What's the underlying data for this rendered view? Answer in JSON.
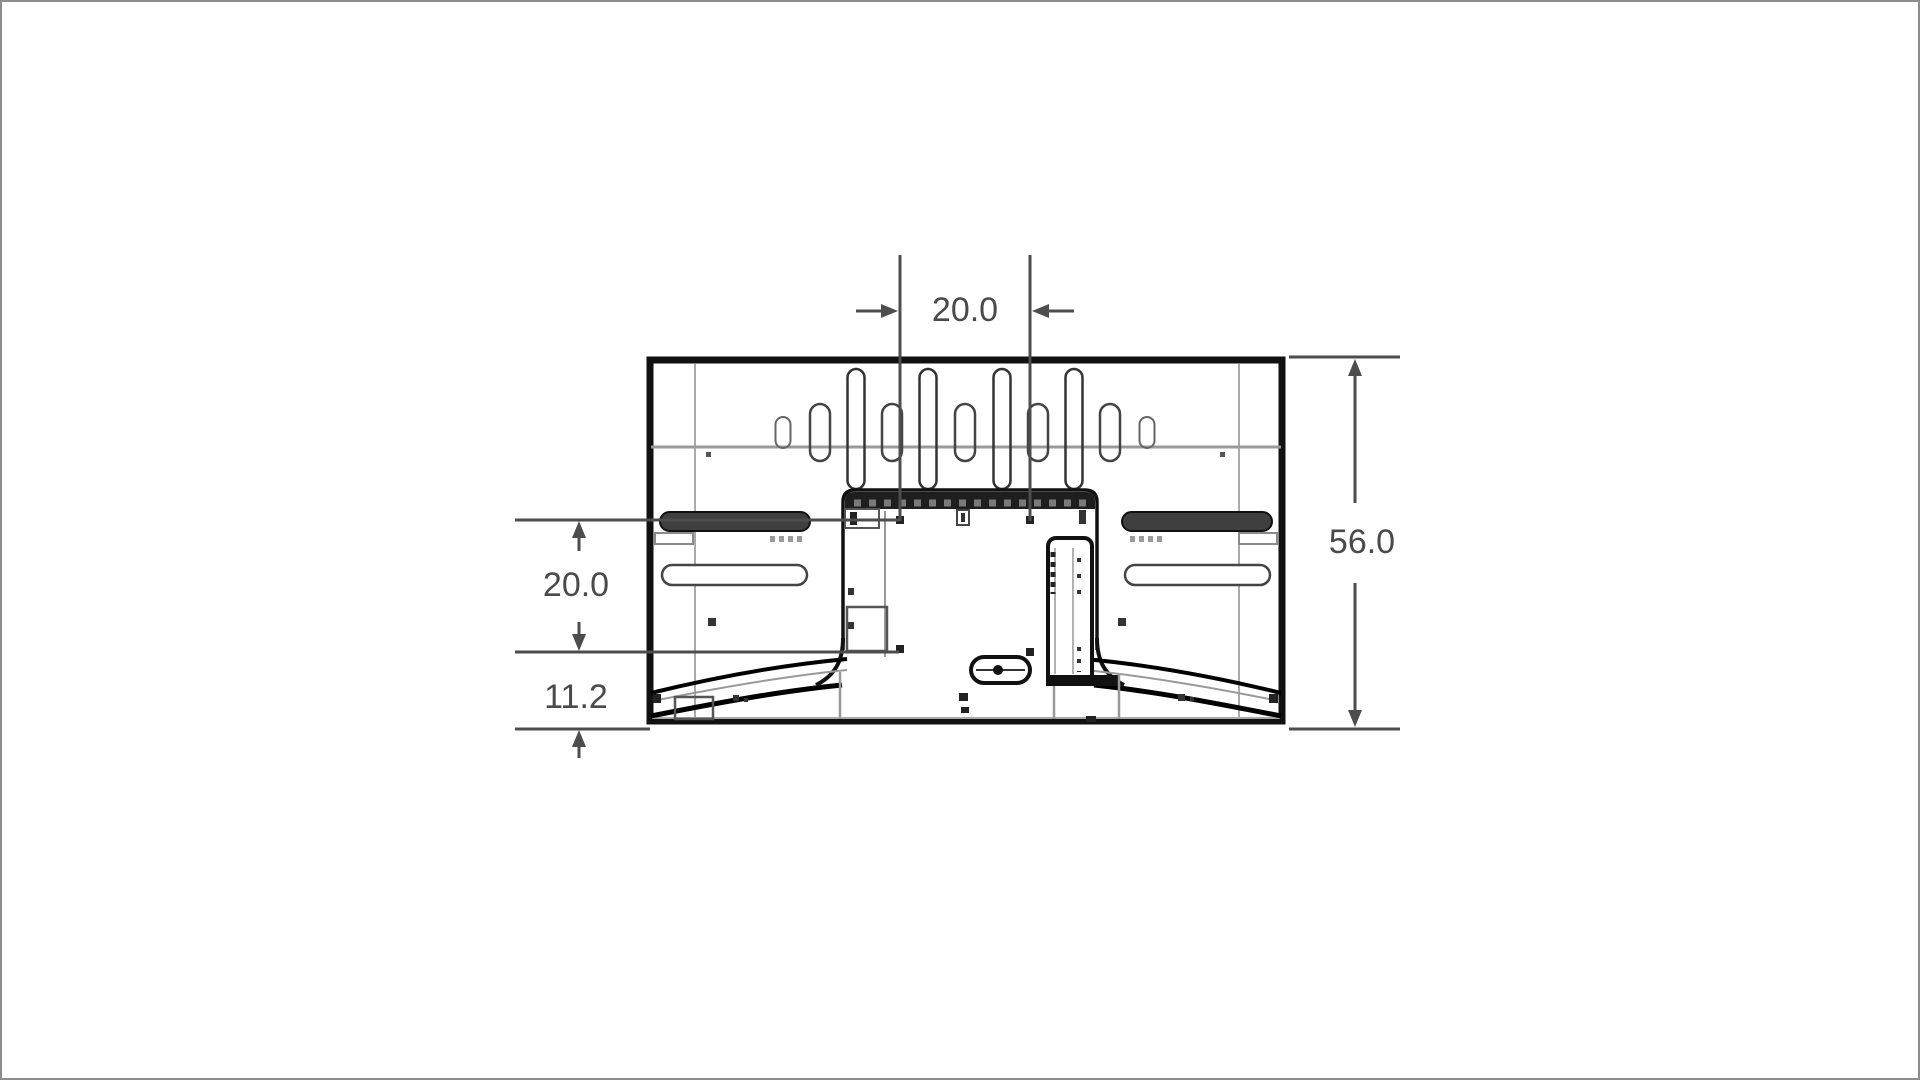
{
  "diagram": {
    "type": "technical-dimension-drawing",
    "subject": "tv-rear-view",
    "units_shown": false,
    "colors": {
      "outline": "#111111",
      "secondary_line": "#999999",
      "dimension_line": "#4d4d4d",
      "label_text": "#4a4a4a",
      "background": "#ffffff",
      "page_border": "#8c8c8c"
    },
    "dimensions": {
      "vesa_horizontal": {
        "label": "20.0",
        "orientation": "horizontal",
        "position": "top"
      },
      "overall_height": {
        "label": "56.0",
        "orientation": "vertical",
        "position": "right"
      },
      "vesa_vertical": {
        "label": "20.0",
        "orientation": "vertical",
        "position": "left"
      },
      "bottom_offset": {
        "label": "11.2",
        "orientation": "vertical",
        "position": "left-bottom"
      }
    }
  }
}
